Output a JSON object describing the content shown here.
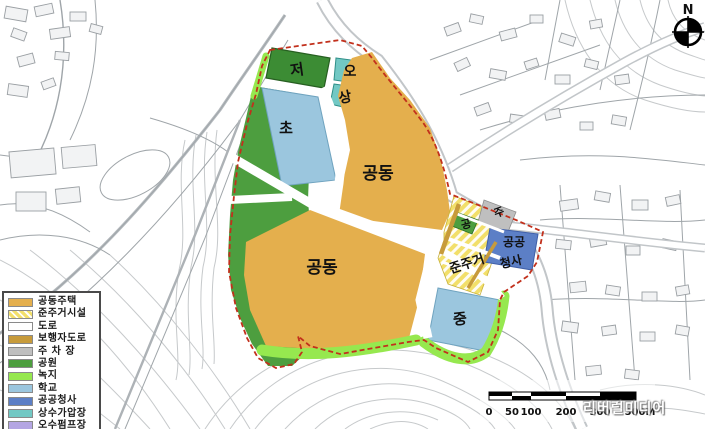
{
  "colors": {
    "apartment": "#E4AF4D",
    "semi_residential": "#F2DF6A",
    "road": "#FFFFFF",
    "pedestrian_road": "#C79B3B",
    "parking": "#BFBFBF",
    "park": "#4D9E3F",
    "green_buffer": "#96E84F",
    "school": "#9BC6DE",
    "public_office": "#5C7FC6",
    "water_pressure": "#72C8C4",
    "sewage_pump": "#B4A6E3",
    "reservoir": "#3C8C34",
    "boundary": "#C2301C"
  },
  "legend": {
    "items": [
      {
        "label": "공동주택",
        "color": "#E4AF4D"
      },
      {
        "label": "준주거시설",
        "color": "#F2DF6A",
        "hatch": true
      },
      {
        "label": "도로",
        "color": "#FFFFFF"
      },
      {
        "label": "보행자도로",
        "color": "#C79B3B"
      },
      {
        "label": "주 차 장",
        "color": "#BFBFBF"
      },
      {
        "label": "공원",
        "color": "#4D9E3F"
      },
      {
        "label": "녹지",
        "color": "#96E84F"
      },
      {
        "label": "학교",
        "color": "#9BC6DE"
      },
      {
        "label": "공공청사",
        "color": "#5C7FC6"
      },
      {
        "label": "상수가압장",
        "color": "#72C8C4"
      },
      {
        "label": "오수펌프장",
        "color": "#B4A6E3"
      }
    ]
  },
  "map": {
    "labels": [
      {
        "text": "저"
      },
      {
        "text": "오"
      },
      {
        "text": "상"
      },
      {
        "text": "초"
      },
      {
        "text": "공동"
      },
      {
        "text": "공동"
      },
      {
        "text": "준주거"
      },
      {
        "text": "공"
      },
      {
        "text": "주"
      },
      {
        "text": "공공"
      },
      {
        "text": "청사"
      },
      {
        "text": "중"
      }
    ]
  },
  "compass": {
    "label": "N"
  },
  "scalebar": {
    "ticks": [
      "0",
      "50",
      "100",
      "200",
      "300",
      "500M"
    ]
  },
  "watermark": {
    "text": "리버럴미디어"
  }
}
